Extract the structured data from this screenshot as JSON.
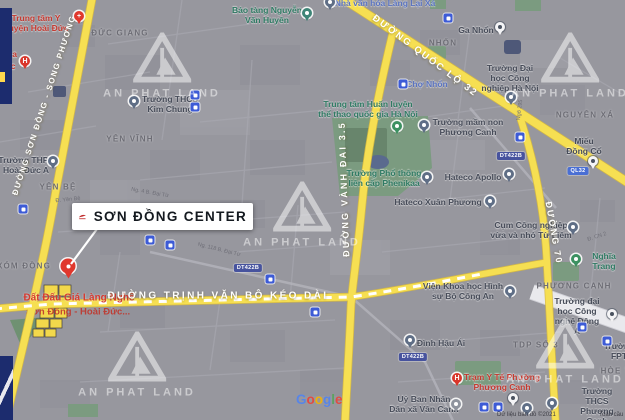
{
  "watermark_text": "AN PHAT LAND",
  "watermarks": [
    [
      162,
      66
    ],
    [
      570,
      66
    ],
    [
      302,
      215
    ],
    [
      137,
      365
    ],
    [
      565,
      352
    ]
  ],
  "callout": {
    "title": "SƠN ĐỒNG CENTER"
  },
  "annotation": {
    "line1": "Đất Đấu Giá Làng Nghề",
    "line2": "Sơn Đồng - Hoài Đức..."
  },
  "footer": {
    "logo": "Google",
    "logo_colors": [
      "#5384ee",
      "#e8453c",
      "#f5b400",
      "#5384ee",
      "#57a45c",
      "#e8453c"
    ],
    "attribution": "Dữ liệu bản đồ ©2021",
    "terms": "Toàn cầu"
  },
  "road_labels": [
    {
      "t": "ĐƯỜNG SƠN ĐỒNG - SONG PHƯƠNG",
      "x": 44,
      "y": 105,
      "r": -72,
      "fs": 8,
      "ls": 1.5
    },
    {
      "t": "ĐƯỜNG QUỐC LỘ 32",
      "x": 425,
      "y": 56,
      "r": 37,
      "fs": 9.5,
      "ls": 2
    },
    {
      "t": "ĐƯỜNG VÀNH ĐAI 3.5",
      "x": 344,
      "y": 189,
      "r": -92,
      "fs": 9,
      "ls": 2.2
    },
    {
      "t": "ĐƯỜNG 70",
      "x": 554,
      "y": 233,
      "r": 80,
      "fs": 9,
      "ls": 2
    },
    {
      "t": "ĐƯỜNG TRỊNH VĂN BÔ KÉO DÀI",
      "x": 218,
      "y": 296,
      "r": 0,
      "fs": 10,
      "ls": 2.4
    }
  ],
  "areas": [
    {
      "t": "ĐỨC GIANG",
      "x": 120,
      "y": 33
    },
    {
      "t": "NHỔN",
      "x": 443,
      "y": 43
    },
    {
      "t": "NGUYÊN XÁ",
      "x": 585,
      "y": 115
    },
    {
      "t": "YÊN VĨNH",
      "x": 130,
      "y": 139
    },
    {
      "t": "YÊN BỆ",
      "x": 58,
      "y": 187
    },
    {
      "t": "XÓM ĐỒNG",
      "x": 24,
      "y": 266
    },
    {
      "t": "PHƯƠNG CANH",
      "x": 574,
      "y": 286
    },
    {
      "t": "TDP SỐ 3",
      "x": 536,
      "y": 345
    },
    {
      "t": "HÒE THỊ",
      "x": 621,
      "y": 371
    }
  ],
  "pois": [
    {
      "t": "Trung tâm Y\nhuyện Hoài Đức",
      "x": 36,
      "y": 23,
      "c": "red"
    },
    {
      "t": "Bảo tàng Nguyễn\nVăn Huyên",
      "x": 267,
      "y": 15,
      "c": "green"
    },
    {
      "t": "Nhà văn hóa Làng Lại Xá",
      "x": 385,
      "y": 3,
      "c": "blue"
    },
    {
      "t": "Ga Nhổn",
      "x": 476,
      "y": 30,
      "c": "dark"
    },
    {
      "t": "Trường Đại\nhọc Công\nnghiệp Hà Nội",
      "x": 510,
      "y": 78,
      "c": "dark"
    },
    {
      "t": "Chợ Nhổn",
      "x": 427,
      "y": 84,
      "c": "blue"
    },
    {
      "t": "Trung tâm Huấn luyện\nthể thao quốc gia Hà Nội",
      "x": 368,
      "y": 109,
      "c": "green"
    },
    {
      "t": "Trường THCS\nKim Chung",
      "x": 170,
      "y": 104,
      "c": "dark"
    },
    {
      "t": "Trường mầm non\nPhương Canh",
      "x": 468,
      "y": 127,
      "c": "dark"
    },
    {
      "t": "Miếu Đồng Cổ",
      "x": 584,
      "y": 146,
      "c": "dark"
    },
    {
      "t": "Trường THPT\nHoài Đức A",
      "x": 26,
      "y": 165,
      "c": "dark"
    },
    {
      "t": "Trường Phổ thông\nliên cấp Phenikaa",
      "x": 384,
      "y": 178,
      "c": "green"
    },
    {
      "t": "Hateco Apollo",
      "x": 473,
      "y": 177,
      "c": "dark"
    },
    {
      "t": "Hateco Xuân Phương",
      "x": 438,
      "y": 202,
      "c": "dark"
    },
    {
      "t": "Cụm Công nghiệp\nvừa và nhỏ Từ Liêm",
      "x": 531,
      "y": 230,
      "c": "dark"
    },
    {
      "t": "Nghĩa Trang",
      "x": 604,
      "y": 261,
      "c": "green"
    },
    {
      "t": "Viện Khoa học Hình\nsự Bộ Công An",
      "x": 463,
      "y": 291,
      "c": "dark"
    },
    {
      "t": "Trường đại\nhọc Công\nnghệ Đông Á",
      "x": 577,
      "y": 316,
      "c": "dark"
    },
    {
      "t": "Đình Hậu Ái",
      "x": 441,
      "y": 343,
      "c": "dark"
    },
    {
      "t": "Trường\nFPT",
      "x": 619,
      "y": 351,
      "c": "dark"
    },
    {
      "t": "Trạm Y Tế Phường\nPhương Canh",
      "x": 502,
      "y": 382,
      "c": "red"
    },
    {
      "t": "Trường THCS\nPhương Canh",
      "x": 597,
      "y": 406,
      "c": "dark"
    },
    {
      "t": "Uỷ Ban Nhân\nDân xã Vân Canh",
      "x": 424,
      "y": 404,
      "c": "dark"
    },
    {
      "t": "oa",
      "x": 12,
      "y": 54,
      "c": "red"
    },
    {
      "t": "ức",
      "x": 10,
      "y": 66,
      "c": "red"
    }
  ],
  "streets": [
    {
      "t": "Đ. Yên Bệ",
      "x": 68,
      "y": 200,
      "r": -6
    },
    {
      "t": "Ngõ 295",
      "x": 520,
      "y": 110,
      "r": -83
    },
    {
      "t": "Đ. CN 2",
      "x": 597,
      "y": 237,
      "r": -18
    },
    {
      "t": "Ng. 4 B. Đại Từ",
      "x": 150,
      "y": 193,
      "r": 10
    },
    {
      "t": "Ng. 118 B. Đại Từ",
      "x": 219,
      "y": 250,
      "r": 14
    }
  ],
  "badges": [
    {
      "t": "DT422B",
      "x": 248,
      "y": 268,
      "c": "indigo"
    },
    {
      "t": "DT422B",
      "x": 413,
      "y": 357,
      "c": "indigo"
    },
    {
      "t": "DT422B",
      "x": 511,
      "y": 156,
      "c": "indigo"
    },
    {
      "t": "QL32",
      "x": 578,
      "y": 171,
      "c": "blue"
    }
  ],
  "pin_colors": {
    "big": "#e0382d",
    "red": "#e0382d",
    "redh": "#d9362b",
    "teal": "#3e8577",
    "green": "#3c9161",
    "slate": "#5f6e86",
    "gray": "#8f949e",
    "white": "#f4f4f6"
  },
  "pins": [
    {
      "k": "big",
      "x": 68,
      "y": 266
    },
    {
      "k": "red",
      "x": 79,
      "y": 16,
      "g": "+"
    },
    {
      "k": "redh",
      "x": 25,
      "y": 61,
      "g": "H"
    },
    {
      "k": "teal",
      "x": 307,
      "y": 13
    },
    {
      "k": "slate",
      "x": 330,
      "y": 2
    },
    {
      "k": "slate",
      "x": 134,
      "y": 101
    },
    {
      "k": "white",
      "x": 500,
      "y": 27
    },
    {
      "k": "slate",
      "x": 511,
      "y": 97
    },
    {
      "k": "slate",
      "x": 53,
      "y": 161
    },
    {
      "k": "green",
      "x": 397,
      "y": 126
    },
    {
      "k": "slate",
      "x": 424,
      "y": 125
    },
    {
      "k": "slate",
      "x": 509,
      "y": 174
    },
    {
      "k": "slate",
      "x": 490,
      "y": 201
    },
    {
      "k": "slate",
      "x": 427,
      "y": 177
    },
    {
      "k": "white",
      "x": 593,
      "y": 161
    },
    {
      "k": "slate",
      "x": 573,
      "y": 227
    },
    {
      "k": "green",
      "x": 576,
      "y": 259
    },
    {
      "k": "slate",
      "x": 510,
      "y": 291
    },
    {
      "k": "white",
      "x": 612,
      "y": 314
    },
    {
      "k": "slate",
      "x": 410,
      "y": 340
    },
    {
      "k": "redh",
      "x": 457,
      "y": 378,
      "g": "H"
    },
    {
      "k": "gray",
      "x": 456,
      "y": 404
    },
    {
      "k": "slate",
      "x": 552,
      "y": 403
    },
    {
      "k": "slate",
      "x": 527,
      "y": 408
    },
    {
      "k": "white",
      "x": 513,
      "y": 398
    }
  ],
  "transit_icons": [
    [
      195,
      95
    ],
    [
      195,
      107
    ],
    [
      448,
      18
    ],
    [
      23,
      209
    ],
    [
      150,
      240
    ],
    [
      170,
      245
    ],
    [
      270,
      279
    ],
    [
      315,
      312
    ],
    [
      520,
      137
    ],
    [
      582,
      327
    ],
    [
      607,
      341
    ],
    [
      484,
      407
    ],
    [
      498,
      407
    ],
    [
      403,
      84
    ]
  ],
  "colors": {
    "road_highlight": "#f6df52",
    "overlay_navy": "#1c2c6e",
    "annotation_red": "#d63a30",
    "callout_bg": "#ffffff"
  }
}
